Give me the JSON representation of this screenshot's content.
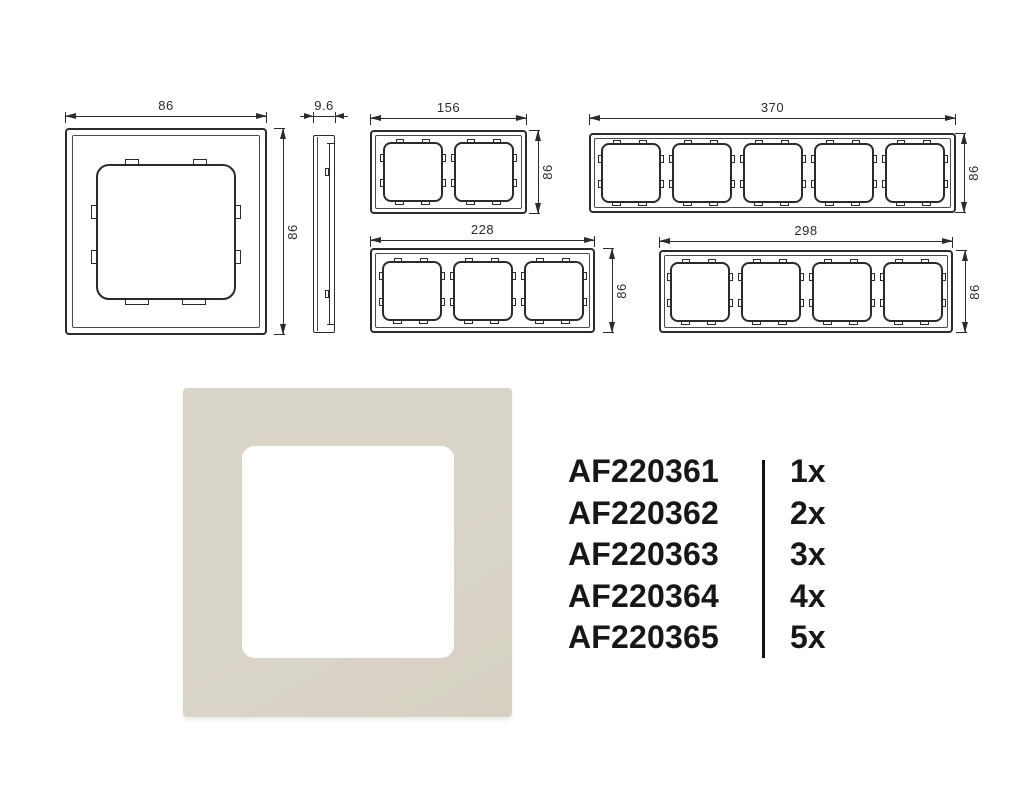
{
  "colors": {
    "line": "#2b2b2b",
    "dim_text": "#2b2b2b",
    "part_text": "#171717",
    "product_frame": "#dad5c9",
    "product_frame_shade": "#d5d0c2"
  },
  "drawings": {
    "single": {
      "gangs": 1,
      "width_label": "86",
      "height_label": "86"
    },
    "profile": {
      "width_label": "9.6"
    },
    "frames": [
      {
        "name": "2-gang frame",
        "gangs": 2,
        "width_label": "156",
        "height_label": "86"
      },
      {
        "name": "5-gang frame",
        "gangs": 5,
        "width_label": "370",
        "height_label": "86"
      },
      {
        "name": "3-gang frame",
        "gangs": 3,
        "width_label": "228",
        "height_label": "86"
      },
      {
        "name": "4-gang frame",
        "gangs": 4,
        "width_label": "298",
        "height_label": "86"
      }
    ]
  },
  "parts": {
    "rows": [
      {
        "code": "AF220361",
        "qty": "1x"
      },
      {
        "code": "AF220362",
        "qty": "2x"
      },
      {
        "code": "AF220363",
        "qty": "3x"
      },
      {
        "code": "AF220364",
        "qty": "4x"
      },
      {
        "code": "AF220365",
        "qty": "5x"
      }
    ]
  }
}
